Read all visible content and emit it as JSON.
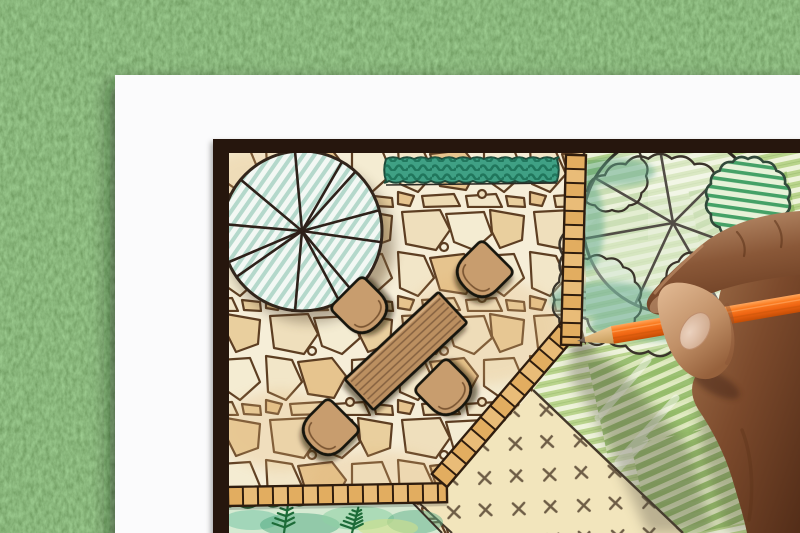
{
  "scene": {
    "type": "photograph",
    "description": "Top-down view of a hand drawing a backyard garden landscape plan with an orange colored pencil on white paper lying on green grass",
    "grass": {
      "label": "grass background",
      "color": "#4d7a40"
    },
    "paper": {
      "label": "white paper sheet",
      "color": "#fbfbfc"
    },
    "plan": {
      "label": "hand-drawn garden landscape plan",
      "frame_color": "#27170e",
      "patio": {
        "label": "flagstone patio",
        "stone_color": "#f0e2c2",
        "joint_color": "#5d3e22",
        "background": "#f6eed8"
      },
      "shade_tree": {
        "label": "round shade tree symbol",
        "hatch_color": "#b4d8cb",
        "outline_color": "#32251b"
      },
      "garden_trees": {
        "label": "tree and shrub symbols",
        "foliage_color": "#45a167",
        "wash_color": "#5ea78c"
      },
      "hedge": {
        "label": "clipped hedge strip",
        "color": "#3fa084"
      },
      "ground_cover": {
        "label": "planted border bed",
        "color": "#d6ead2"
      },
      "lawn": {
        "label": "lawn panel with grading hatch",
        "color": "#f2e5bc"
      },
      "meadow": {
        "label": "green planting area",
        "color": "#b9d48c"
      },
      "tile_border": {
        "label": "paver tile edge band",
        "color": "#e2ad60"
      },
      "table": {
        "label": "rectangular garden dining table",
        "color": "#bb8f60",
        "seats": 4
      },
      "chair_color": "#c89d6e"
    },
    "pencil": {
      "label": "orange colored pencil",
      "body_color": "#f06a14",
      "wood_color": "#ddab72",
      "tip_color": "#6e6157"
    },
    "hand": {
      "label": "right hand gripping pencil",
      "skin_color": "#9c6b4f",
      "nail_color": "#e3c4ae"
    }
  }
}
